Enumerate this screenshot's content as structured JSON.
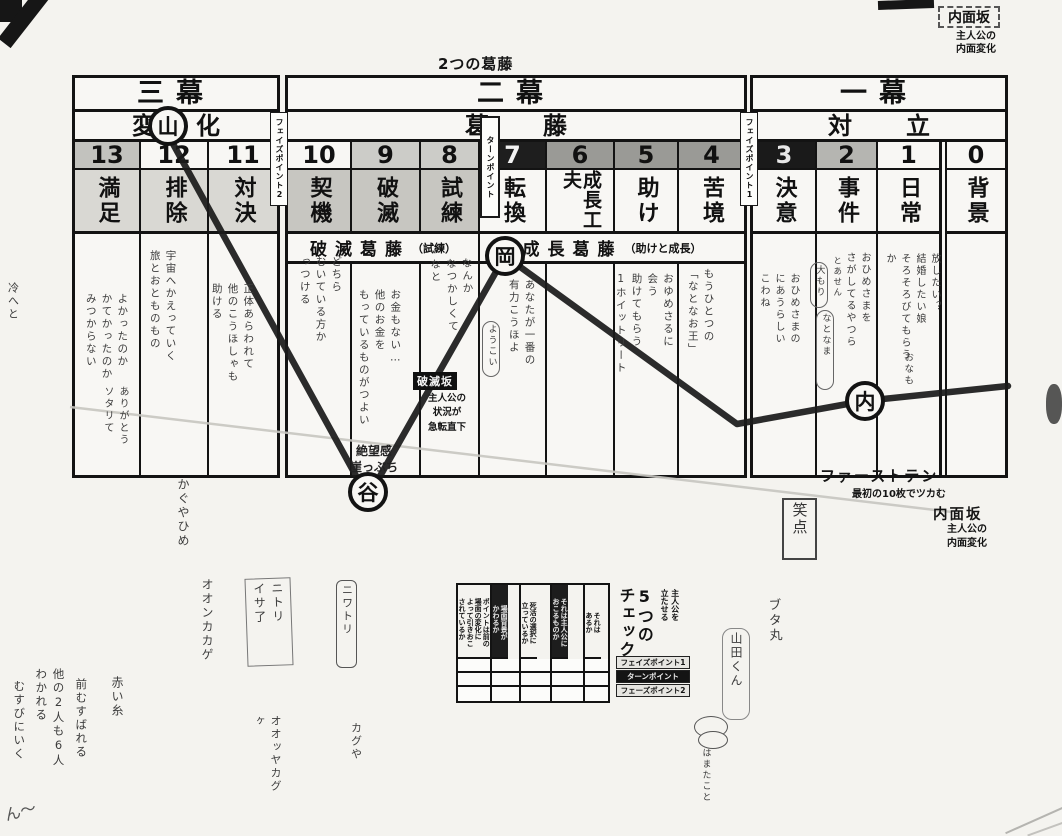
{
  "page_title": "2つの葛藤",
  "top_right_corner": {
    "title": "内面坂",
    "subtitle": "主人公の\n内面変化"
  },
  "acts": {
    "act3": {
      "title": "三幕",
      "theme": "変化",
      "theme_circle": "山"
    },
    "act2": {
      "title": "二幕",
      "theme": "葛藤"
    },
    "act1": {
      "title": "一幕",
      "theme": "対立"
    }
  },
  "phase_points": {
    "phase2": "フェイズポイント2",
    "turn": "ターンポイント",
    "phase1": "フェイズポイント1"
  },
  "columns": [
    {
      "num": "13",
      "label": "満足",
      "note": "よかったのか\nかてかったのか\nみつからない",
      "note2": "ありがとう\nソタリて"
    },
    {
      "num": "12",
      "label": "排除",
      "note": "宇宙へかえっていく\n旅とおとものもの"
    },
    {
      "num": "11",
      "label": "対決",
      "note": "正体あらわれて\n他のこうほしゃも\n助ける"
    },
    {
      "num": "10",
      "label": "契機",
      "note": "どちら\nむいている方か\nっつける"
    },
    {
      "num": "9",
      "label": "破滅",
      "note": "お金もない…\n他のお金を\nもっているものがつよい"
    },
    {
      "num": "8",
      "label": "試練",
      "note": "なんか\nなつかしくて\nなと"
    },
    {
      "num": "7",
      "label": "転換",
      "note": "あなたが一番の\n有力こうほよ",
      "bubble": "ようこい"
    },
    {
      "num": "6",
      "label": "成長工夫"
    },
    {
      "num": "5",
      "label": "助け",
      "note": "おゆめさるに\n会う\n助けてもらう\n1ホイットリート"
    },
    {
      "num": "4",
      "label": "苦境",
      "note": "もうひとつの\n「なとなお王」"
    },
    {
      "num": "3",
      "label": "決意",
      "note": "おひめさまの\nにあうらしい\nこわね"
    },
    {
      "num": "2",
      "label": "事件",
      "note": "おひめさまを\nさがしてるやつら",
      "bubble1": "大もり",
      "bubble2": "なとなま",
      "small": "とあせん"
    },
    {
      "num": "1",
      "label": "日常",
      "note": "放したい？\n結婚したい娘\nそろそろびてもらうか",
      "small": "おなも"
    },
    {
      "num": "0",
      "label": "背景"
    }
  ],
  "band": {
    "left_title": "破滅葛藤",
    "left_sub": "（試練）",
    "right_title": "成長葛藤",
    "right_sub": "（助けと成長）"
  },
  "markers": {
    "mountain": "山",
    "valley": "谷",
    "hill": "岡",
    "inner": "内"
  },
  "labels": {
    "hametsu_title": "破滅坂",
    "hametsu_body": "主人公の\n状況が\n急転直下",
    "zetsubo": "絶望感\n崖っぷち",
    "first_ten_title": "ファーストテン",
    "first_ten_sub": "最初の10枚でツカむ",
    "inner_title": "内面坂",
    "inner_sub": "主人公の\n内面変化"
  },
  "check_table": {
    "head_small": "主人公を\n立たせる",
    "head_big": "5つの\nチェック",
    "columns": [
      "ポイントは前の\n場面の変化に\nよって引きおこ\nされているか",
      "場面背景が\nかわるか",
      "死活の選択に\n立っているか",
      "それは主人公に\nおこるものか",
      "それは\nあるか"
    ],
    "rows": [
      "フェイズポイント1",
      "ターンポイント",
      "フェーズポイント2"
    ]
  },
  "doodles": {
    "kaguya": "かぐやひめ",
    "oonkakage": "オオンカカゲ",
    "futari_box": "ニトリ\nイサ了",
    "niwatori": "ニワトリ",
    "kaguya2": "カグや",
    "ookkayakagu": "オオッヤカグ\nヶ",
    "akaiito": "赤い糸",
    "musubareru": "前むすばれる",
    "hokano": "他の2人も6人\nわかれる",
    "musubini": "むすびにいく",
    "shoten": "笑点",
    "butamaru": "ブタ丸",
    "yamadakun": "山田くん",
    "hamatako": "はまたこと",
    "hidari": "冷へと",
    "corner": "ん〜"
  },
  "fortune_line": {
    "stroke": "#1b1b1b",
    "points": [
      [
        172,
        142
      ],
      [
        366,
        494
      ],
      [
        371,
        492
      ],
      [
        505,
        256
      ],
      [
        737,
        424
      ],
      [
        864,
        401
      ],
      [
        1008,
        386
      ]
    ]
  },
  "inner_line": {
    "stroke": "#c6c5c0",
    "points": [
      [
        70,
        407
      ],
      [
        952,
        512
      ]
    ]
  },
  "colors": {
    "ink": "#131313",
    "paper": "#f4f3ef",
    "cell_gray_light": "#d9d8d3",
    "cell_gray": "#c7c6c1",
    "cell_dark": "#9a9a96",
    "reversed": "#1a1a1a",
    "pencil": "#c6c5c0"
  }
}
